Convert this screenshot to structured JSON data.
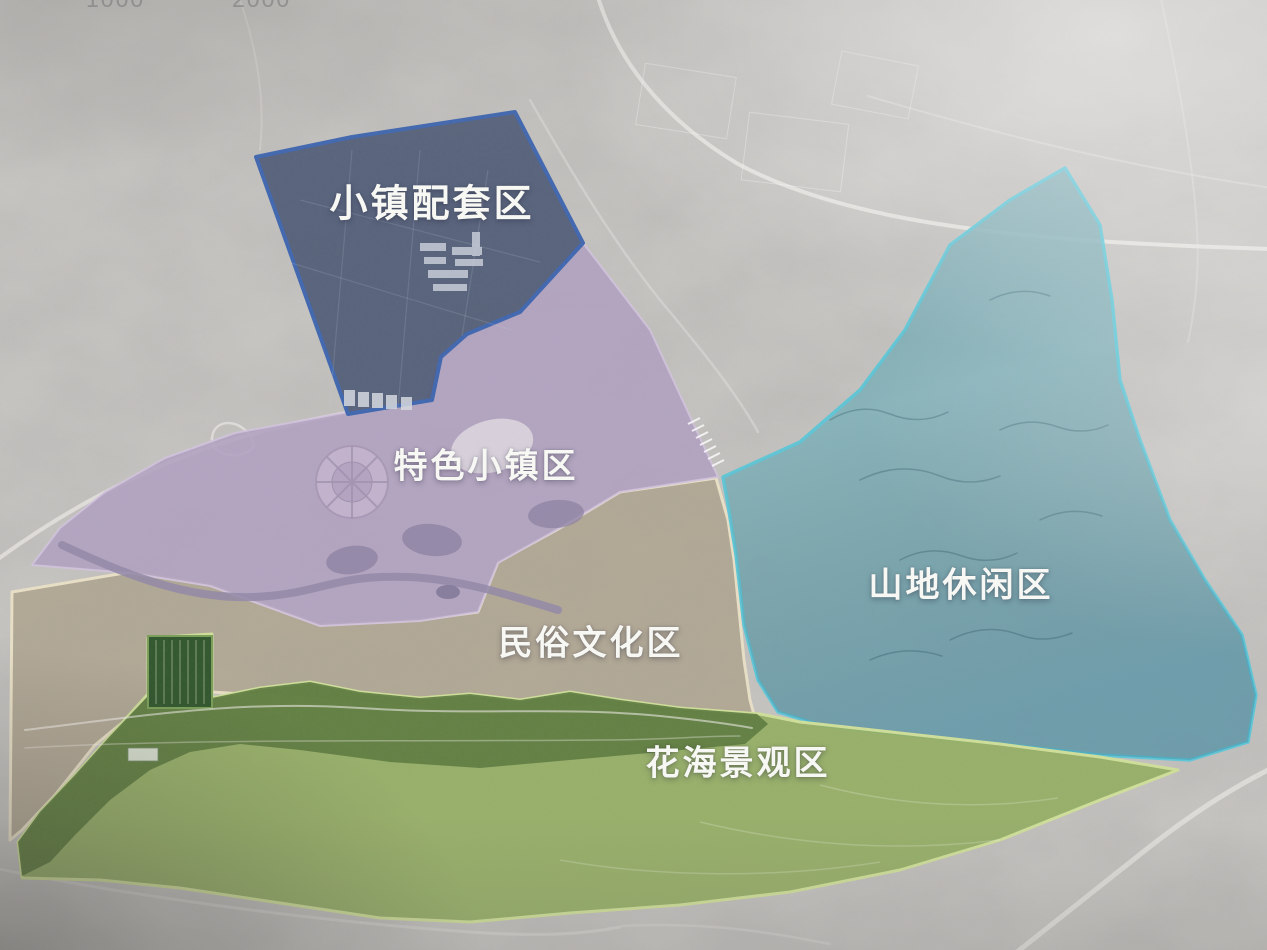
{
  "map": {
    "base_background": "#c7c5c2",
    "scale_labels": [
      "1000",
      "2000"
    ],
    "zones": [
      {
        "key": "town-support",
        "label": "小镇配套区",
        "fill": "#515d77",
        "border": "#4268b0",
        "label_color": "#f7f7f4"
      },
      {
        "key": "featured-town",
        "label": "特色小镇区",
        "fill": "#b1a0c0",
        "border": "#d2c4de",
        "label_color": "#f7f7f4"
      },
      {
        "key": "folk-culture",
        "label": "民俗文化区",
        "fill": "#b0a693",
        "border": "#e8dfc6",
        "label_color": "#f7f7f4"
      },
      {
        "key": "mountain-leisure",
        "label": "山地休闲区",
        "fill": "#7fb0ba",
        "border": "#62c6d6",
        "label_color": "#f7f7f4"
      },
      {
        "key": "flower-sea",
        "label": "花海景观区",
        "fill": "#93ae62",
        "border": "#cfdf9a",
        "accent_park_band": "#5c7a40",
        "label_color": "#f7f7f4"
      }
    ]
  }
}
